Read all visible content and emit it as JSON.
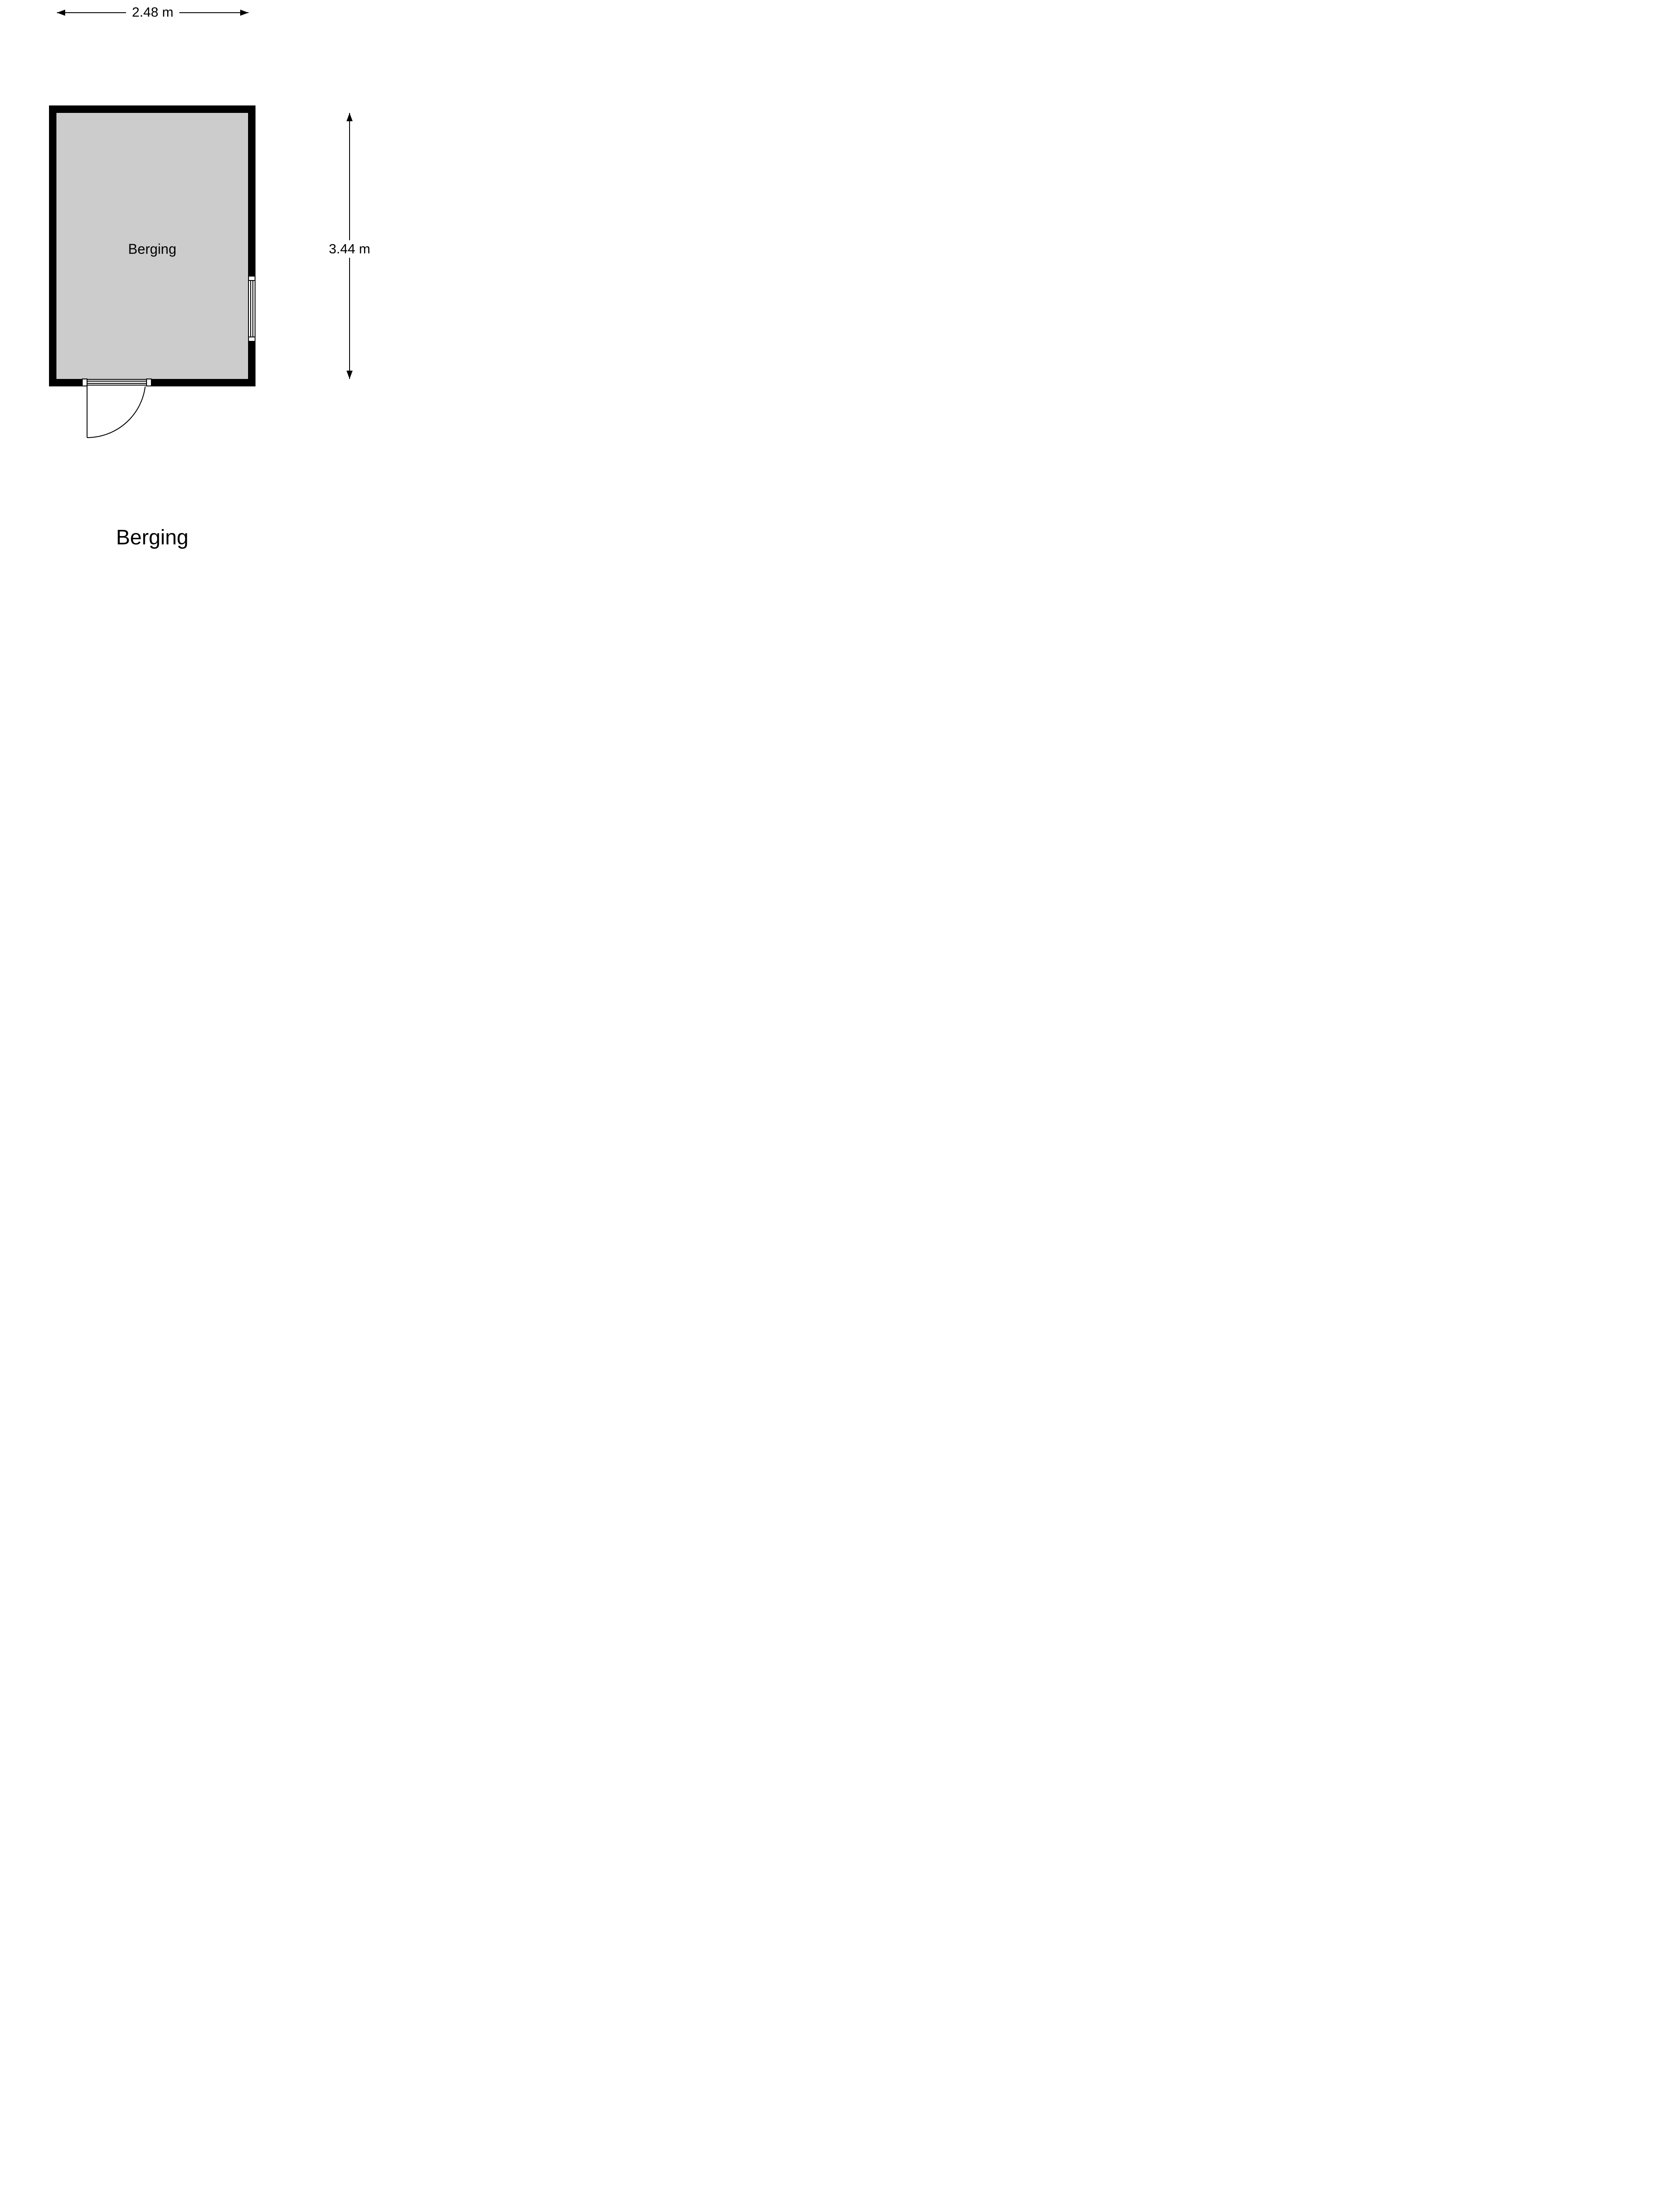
{
  "colors": {
    "background": "#FFFFFF",
    "wall": "#000000",
    "floor": "#CCCCCC",
    "line": "#000000",
    "text": "#000000"
  },
  "floor_plan": {
    "title": "Berging",
    "room": {
      "name": "Berging"
    },
    "dimensions": {
      "width": {
        "label": "2.48 m"
      },
      "height": {
        "label": "3.44 m"
      }
    }
  }
}
